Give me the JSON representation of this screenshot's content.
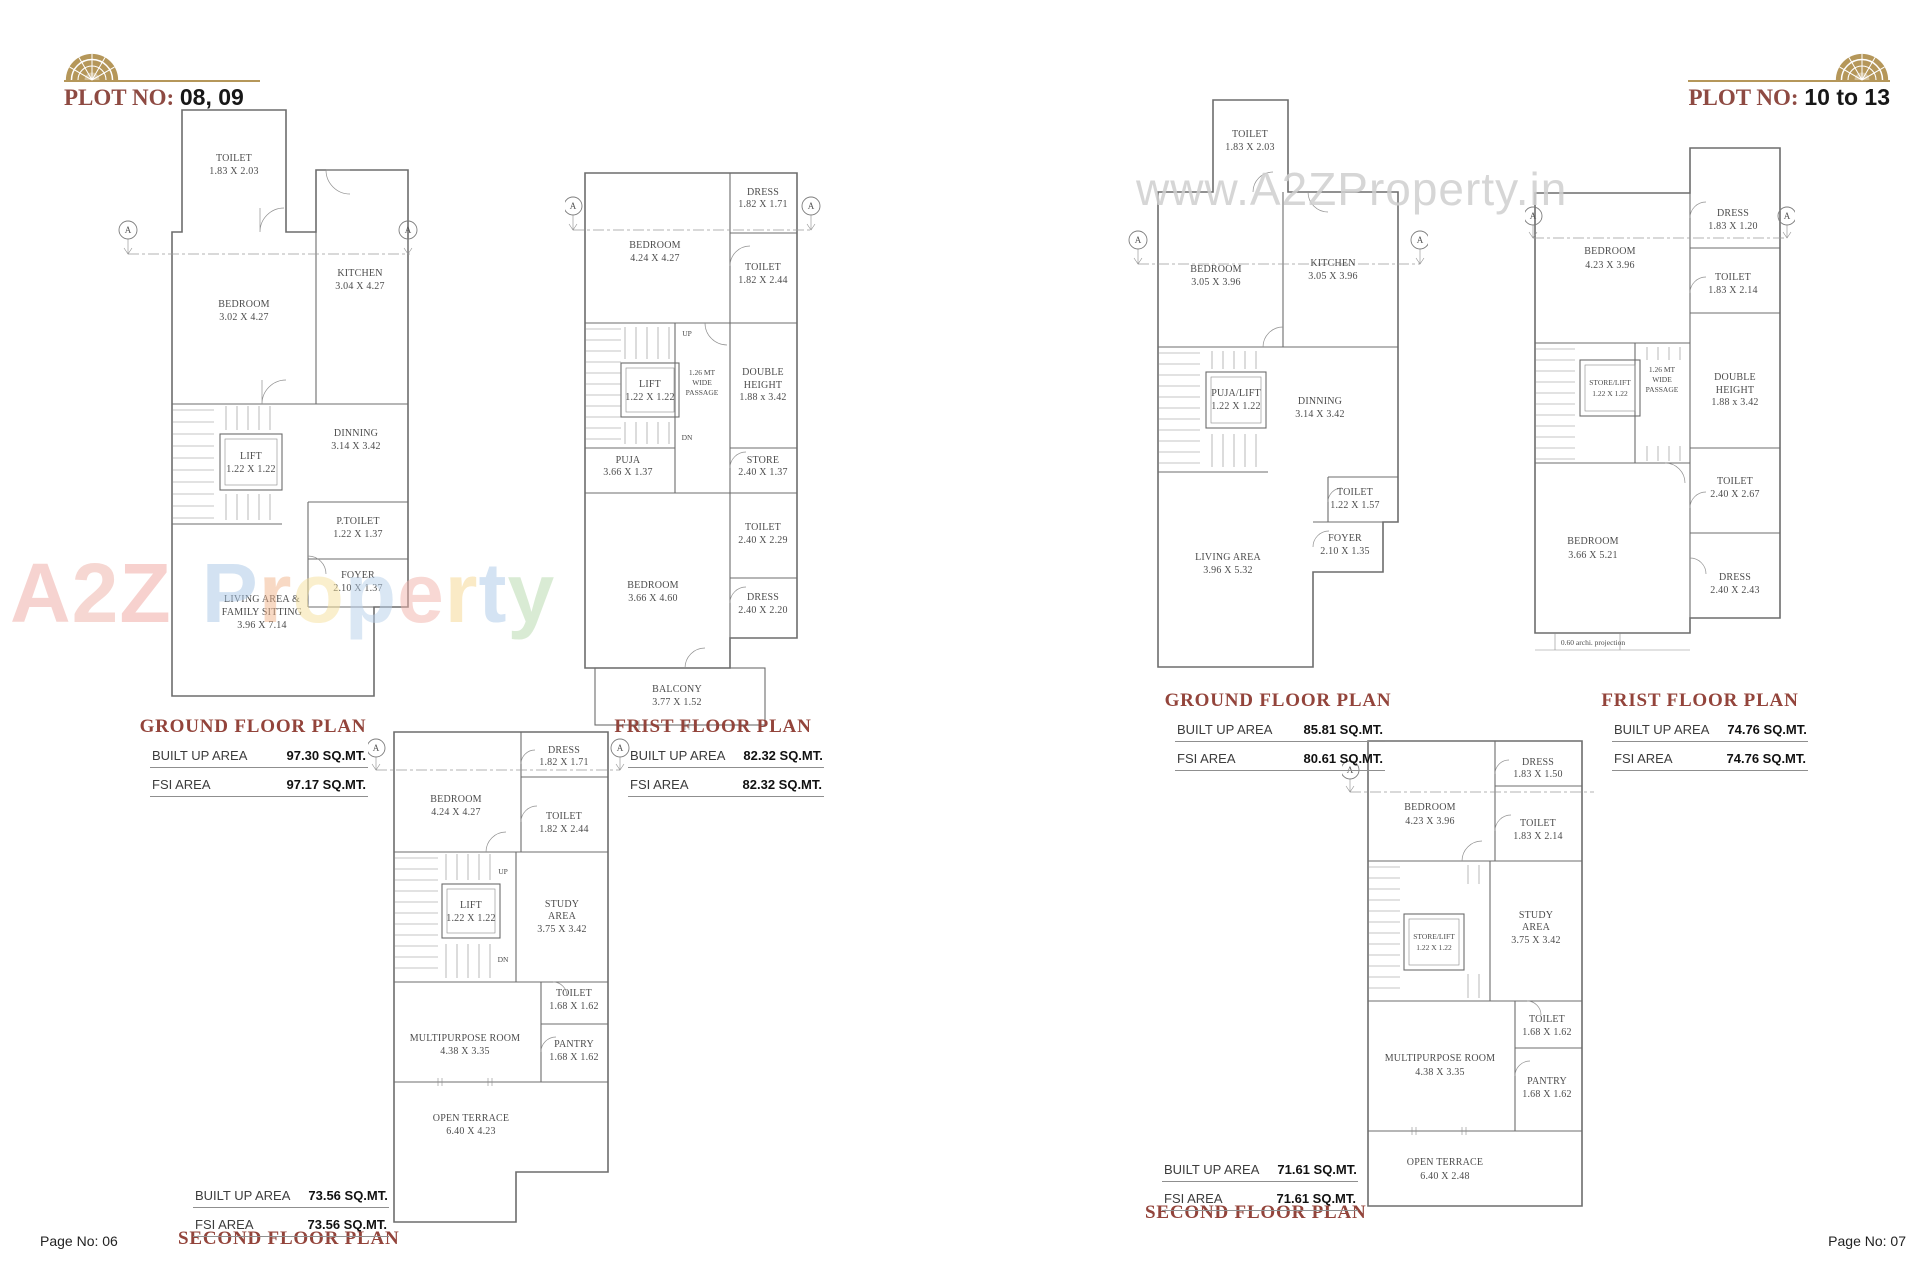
{
  "section_marker": "A",
  "colors": {
    "maroon": "#8e4a42",
    "gold": "#b5975a",
    "wall_gray": "#6d6d6d",
    "watermark_gray": "#d0d0d0"
  },
  "left": {
    "header": {
      "plot_label": "PLOT NO:",
      "plot_value": "08, 09"
    },
    "page_no": "Page No: 06",
    "watermark": {
      "l1": "A",
      "l2": "2",
      "l3": "Z",
      "l4": "P",
      "l5": "r",
      "l6": "o",
      "l7": "p",
      "l8": "e",
      "l9": "r",
      "l10": "t",
      "l11": "y"
    },
    "ground": {
      "title": "GROUND FLOOR PLAN",
      "areas": {
        "built_label": "BUILT UP AREA",
        "built_value": "97.30 SQ.MT.",
        "fsi_label": "FSI AREA",
        "fsi_value": "97.17 SQ.MT."
      },
      "rooms": {
        "toilet": {
          "name": "TOILET",
          "dims": "1.83 X 2.03"
        },
        "bedroom": {
          "name": "BEDROOM",
          "dims": "3.02 X 4.27"
        },
        "kitchen": {
          "name": "KITCHEN",
          "dims": "3.04 X 4.27"
        },
        "lift": {
          "name": "LIFT",
          "dims": "1.22 X 1.22"
        },
        "dinning": {
          "name": "DINNING",
          "dims": "3.14 X 3.42"
        },
        "ptoilet": {
          "name": "P.TOILET",
          "dims": "1.22 X 1.37"
        },
        "foyer": {
          "name": "FOYER",
          "dims": "2.10 X 1.37"
        },
        "living": {
          "name1": "LIVING AREA &",
          "name2": "FAMILY SITTING",
          "dims": "3.96 X 7.14"
        }
      }
    },
    "first": {
      "title": "FRIST FLOOR PLAN",
      "areas": {
        "built_label": "BUILT UP AREA",
        "built_value": "82.32 SQ.MT.",
        "fsi_label": "FSI AREA",
        "fsi_value": "82.32 SQ.MT."
      },
      "rooms": {
        "bedroom1": {
          "name": "BEDROOM",
          "dims": "4.24 X 4.27"
        },
        "dress1": {
          "name": "DRESS",
          "dims": "1.82 X 1.71"
        },
        "toilet1": {
          "name": "TOILET",
          "dims": "1.82 X 2.44"
        },
        "lift": {
          "name": "LIFT",
          "dims": "1.22 X 1.22"
        },
        "passage": {
          "l1": "1.26 MT",
          "l2": "WIDE",
          "l3": "PASSAGE"
        },
        "double_height": {
          "l1": "DOUBLE",
          "l2": "HEIGHT",
          "dims": "1.88 x 3.42"
        },
        "puja": {
          "name": "PUJA",
          "dims": "3.66 X 1.37"
        },
        "store": {
          "name": "STORE",
          "dims": "2.40 X 1.37"
        },
        "toilet2": {
          "name": "TOILET",
          "dims": "2.40 X 2.29"
        },
        "bedroom2": {
          "name": "BEDROOM",
          "dims": "3.66 X 4.60"
        },
        "dress2": {
          "name": "DRESS",
          "dims": "2.40 X 2.20"
        },
        "balcony": {
          "name": "BALCONY",
          "dims": "3.77 X 1.52"
        },
        "up": "UP",
        "dn": "DN"
      }
    },
    "second": {
      "title": "SECOND FLOOR PLAN",
      "areas": {
        "built_label": "BUILT UP AREA",
        "built_value": "73.56 SQ.MT.",
        "fsi_label": "FSI AREA",
        "fsi_value": "73.56 SQ.MT."
      },
      "rooms": {
        "dress": {
          "name": "DRESS",
          "dims": "1.82 X 1.71"
        },
        "bedroom": {
          "name": "BEDROOM",
          "dims": "4.24 X 4.27"
        },
        "toilet1": {
          "name": "TOILET",
          "dims": "1.82 X 2.44"
        },
        "lift": {
          "name": "LIFT",
          "dims": "1.22 X 1.22"
        },
        "study": {
          "l1": "STUDY",
          "l2": "AREA",
          "dims": "3.75 X 3.42"
        },
        "toilet2": {
          "name": "TOILET",
          "dims": "1.68 X 1.62"
        },
        "multipurpose": {
          "name": "MULTIPURPOSE ROOM",
          "dims": "4.38 X 3.35"
        },
        "pantry": {
          "name": "PANTRY",
          "dims": "1.68 X 1.62"
        },
        "terrace": {
          "name": "OPEN TERRACE",
          "dims": "6.40 X 4.23"
        },
        "up": "UP",
        "dn": "DN"
      }
    }
  },
  "right": {
    "header": {
      "plot_label": "PLOT NO:",
      "plot_value": "10 to 13"
    },
    "page_no": "Page No: 07",
    "watermark": "www.A2ZProperty.in",
    "ground": {
      "title": "GROUND FLOOR PLAN",
      "areas": {
        "built_label": "BUILT UP AREA",
        "built_value": "85.81 SQ.MT.",
        "fsi_label": "FSI AREA",
        "fsi_value": "80.61 SQ.MT."
      },
      "rooms": {
        "toilet": {
          "name": "TOILET",
          "dims": "1.83 X 2.03"
        },
        "bedroom": {
          "name": "BEDROOM",
          "dims": "3.05 X 3.96"
        },
        "kitchen": {
          "name": "KITCHEN",
          "dims": "3.05 X 3.96"
        },
        "puja_lift": {
          "name": "PUJA/LIFT",
          "dims": "1.22 X 1.22"
        },
        "dinning": {
          "name": "DINNING",
          "dims": "3.14 X 3.42"
        },
        "toilet2": {
          "name": "TOILET",
          "dims": "1.22 X 1.57"
        },
        "foyer": {
          "name": "FOYER",
          "dims": "2.10 X 1.35"
        },
        "living": {
          "name": "LIVING AREA",
          "dims": "3.96 X 5.32"
        }
      }
    },
    "first": {
      "title": "FRIST FLOOR PLAN",
      "areas": {
        "built_label": "BUILT UP AREA",
        "built_value": "74.76 SQ.MT.",
        "fsi_label": "FSI AREA",
        "fsi_value": "74.76 SQ.MT."
      },
      "rooms": {
        "bedroom1": {
          "name": "BEDROOM",
          "dims": "4.23 X 3.96"
        },
        "dress1": {
          "name": "DRESS",
          "dims": "1.83 X 1.20"
        },
        "toilet1": {
          "name": "TOILET",
          "dims": "1.83 X 2.14"
        },
        "store_lift": {
          "name": "STORE/LIFT",
          "dims": "1.22 X 1.22"
        },
        "passage": {
          "l1": "1.26 MT",
          "l2": "WIDE",
          "l3": "PASSAGE"
        },
        "double_height": {
          "l1": "DOUBLE",
          "l2": "HEIGHT",
          "dims": "1.88 x 3.42"
        },
        "toilet2": {
          "name": "TOILET",
          "dims": "2.40 X 2.67"
        },
        "bedroom2": {
          "name": "BEDROOM",
          "dims": "3.66 X 5.21"
        },
        "dress2": {
          "name": "DRESS",
          "dims": "2.40 X 2.43"
        },
        "note": "0.60 archi. projection"
      }
    },
    "second": {
      "title": "SECOND FLOOR PLAN",
      "areas": {
        "built_label": "BUILT UP AREA",
        "built_value": "71.61 SQ.MT.",
        "fsi_label": "FSI AREA",
        "fsi_value": "71.61 SQ.MT."
      },
      "rooms": {
        "dress": {
          "name": "DRESS",
          "dims": "1.83 X 1.50"
        },
        "bedroom": {
          "name": "BEDROOM",
          "dims": "4.23 X 3.96"
        },
        "toilet1": {
          "name": "TOILET",
          "dims": "1.83 X 2.14"
        },
        "store_lift": {
          "name": "STORE/LIFT",
          "dims": "1.22 X 1.22"
        },
        "study": {
          "l1": "STUDY",
          "l2": "AREA",
          "dims": "3.75 X 3.42"
        },
        "toilet2": {
          "name": "TOILET",
          "dims": "1.68 X 1.62"
        },
        "multipurpose": {
          "name": "MULTIPURPOSE ROOM",
          "dims": "4.38 X 3.35"
        },
        "pantry": {
          "name": "PANTRY",
          "dims": "1.68 X 1.62"
        },
        "terrace": {
          "name": "OPEN TERRACE",
          "dims": "6.40 X 2.48"
        }
      }
    }
  }
}
